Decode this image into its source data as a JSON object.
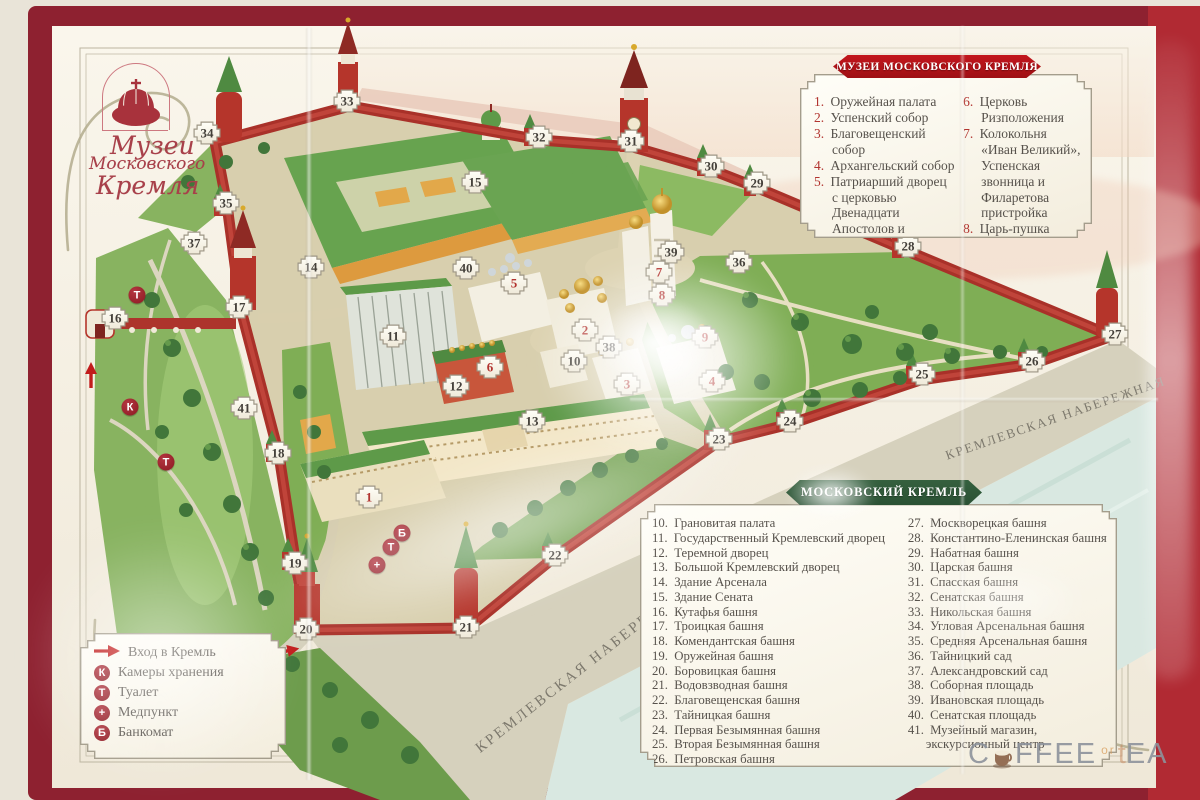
{
  "colors": {
    "border_red": "#8e2130",
    "banner_red": "#c3161d",
    "banner_green": "#2a5134",
    "marker_red": "#b23430",
    "wall_red": "#a93129",
    "paper": "#f7f3e8",
    "text": "#57524c",
    "logo_red": "#a8404a"
  },
  "logo": {
    "line1": "Музеи",
    "line2": "Московского",
    "line3": "Кремля"
  },
  "legend_museums": {
    "banner": "МУЗЕИ МОСКОВСКОГО КРЕМЛЯ",
    "items_left": [
      {
        "n": "1",
        "text": "Оружейная палата"
      },
      {
        "n": "2",
        "text": "Успенский собор"
      },
      {
        "n": "3",
        "text": "Благовещенский собор"
      },
      {
        "n": "4",
        "text": "Архангельский собор"
      },
      {
        "n": "5",
        "text": "Патриарший дворец с церковью Двенадцати Апостолов и выставочный зал в Одностолпной палате"
      }
    ],
    "items_right": [
      {
        "n": "6",
        "text": "Церковь Ризположения"
      },
      {
        "n": "7",
        "text": "Колокольня «Иван Великий», Успенская звонница и Филаретова пристройка"
      },
      {
        "n": "8",
        "text": "Царь-пушка"
      },
      {
        "n": "9",
        "text": "Царь-колокол"
      }
    ]
  },
  "legend_kremlin": {
    "banner": "МОСКОВСКИЙ КРЕМЛЬ",
    "items_left": [
      {
        "n": "10",
        "text": "Грановитая палата"
      },
      {
        "n": "11",
        "text": "Государственный Кремлевский дворец"
      },
      {
        "n": "12",
        "text": "Теремной дворец"
      },
      {
        "n": "13",
        "text": "Большой Кремлевский дворец"
      },
      {
        "n": "14",
        "text": "Здание Арсенала"
      },
      {
        "n": "15",
        "text": "Здание Сената"
      },
      {
        "n": "16",
        "text": "Кутафья башня"
      },
      {
        "n": "17",
        "text": "Троицкая башня"
      },
      {
        "n": "18",
        "text": "Комендантская башня"
      },
      {
        "n": "19",
        "text": "Оружейная башня"
      },
      {
        "n": "20",
        "text": "Боровицкая башня"
      },
      {
        "n": "21",
        "text": "Водовзводная башня"
      },
      {
        "n": "22",
        "text": "Благовещенская башня"
      },
      {
        "n": "23",
        "text": "Тайницкая башня"
      },
      {
        "n": "24",
        "text": "Первая Безымянная башня"
      },
      {
        "n": "25",
        "text": "Вторая Безымянная башня"
      },
      {
        "n": "26",
        "text": "Петровская башня"
      }
    ],
    "items_right": [
      {
        "n": "27",
        "text": "Москворецкая башня"
      },
      {
        "n": "28",
        "text": "Константино-Еленинская башня"
      },
      {
        "n": "29",
        "text": "Набатная башня"
      },
      {
        "n": "30",
        "text": "Царская башня"
      },
      {
        "n": "31",
        "text": "Спасская башня"
      },
      {
        "n": "32",
        "text": "Сенатская башня"
      },
      {
        "n": "33",
        "text": "Никольская башня"
      },
      {
        "n": "34",
        "text": "Угловая Арсенальная башня"
      },
      {
        "n": "35",
        "text": "Средняя Арсенальная башня"
      },
      {
        "n": "36",
        "text": "Тайницкий сад"
      },
      {
        "n": "37",
        "text": "Александровский сад"
      },
      {
        "n": "38",
        "text": "Соборная площадь"
      },
      {
        "n": "39",
        "text": "Ивановская площадь"
      },
      {
        "n": "40",
        "text": "Сенатская площадь"
      },
      {
        "n": "41",
        "text": "Музейный магазин, экскурсионный центр"
      }
    ]
  },
  "legend_services": {
    "items": [
      {
        "icon": "arrow",
        "label": "Вход в Кремль"
      },
      {
        "icon": "К",
        "label": "Камеры хранения"
      },
      {
        "icon": "Т",
        "label": "Туалет"
      },
      {
        "icon": "+",
        "label": "Медпункт"
      },
      {
        "icon": "Б",
        "label": "Банкомат"
      }
    ]
  },
  "map": {
    "embankment_label": "КРЕМЛЕВСКАЯ НАБЕРЕЖНАЯ",
    "markers": [
      {
        "n": "1",
        "x": 369,
        "y": 497,
        "red": true
      },
      {
        "n": "2",
        "x": 585,
        "y": 330,
        "red": true
      },
      {
        "n": "3",
        "x": 627,
        "y": 384,
        "red": true
      },
      {
        "n": "4",
        "x": 712,
        "y": 381,
        "red": true
      },
      {
        "n": "5",
        "x": 514,
        "y": 283,
        "red": true
      },
      {
        "n": "6",
        "x": 490,
        "y": 367,
        "red": true
      },
      {
        "n": "7",
        "x": 659,
        "y": 272,
        "red": true
      },
      {
        "n": "8",
        "x": 662,
        "y": 295,
        "red": true
      },
      {
        "n": "9",
        "x": 705,
        "y": 337,
        "red": true
      },
      {
        "n": "10",
        "x": 574,
        "y": 361
      },
      {
        "n": "11",
        "x": 393,
        "y": 336
      },
      {
        "n": "12",
        "x": 456,
        "y": 386
      },
      {
        "n": "13",
        "x": 532,
        "y": 421
      },
      {
        "n": "14",
        "x": 311,
        "y": 267
      },
      {
        "n": "15",
        "x": 475,
        "y": 182
      },
      {
        "n": "16",
        "x": 115,
        "y": 318
      },
      {
        "n": "17",
        "x": 239,
        "y": 307
      },
      {
        "n": "18",
        "x": 278,
        "y": 453
      },
      {
        "n": "19",
        "x": 295,
        "y": 563
      },
      {
        "n": "20",
        "x": 306,
        "y": 629
      },
      {
        "n": "21",
        "x": 466,
        "y": 627
      },
      {
        "n": "22",
        "x": 555,
        "y": 555
      },
      {
        "n": "23",
        "x": 719,
        "y": 439
      },
      {
        "n": "24",
        "x": 790,
        "y": 421
      },
      {
        "n": "25",
        "x": 922,
        "y": 374
      },
      {
        "n": "26",
        "x": 1032,
        "y": 361
      },
      {
        "n": "27",
        "x": 1115,
        "y": 334
      },
      {
        "n": "28",
        "x": 908,
        "y": 246
      },
      {
        "n": "29",
        "x": 757,
        "y": 183
      },
      {
        "n": "30",
        "x": 711,
        "y": 166
      },
      {
        "n": "31",
        "x": 631,
        "y": 141
      },
      {
        "n": "32",
        "x": 539,
        "y": 137
      },
      {
        "n": "33",
        "x": 347,
        "y": 101
      },
      {
        "n": "34",
        "x": 207,
        "y": 133
      },
      {
        "n": "35",
        "x": 226,
        "y": 203
      },
      {
        "n": "36",
        "x": 739,
        "y": 262
      },
      {
        "n": "37",
        "x": 194,
        "y": 243
      },
      {
        "n": "38",
        "x": 609,
        "y": 347
      },
      {
        "n": "39",
        "x": 671,
        "y": 252
      },
      {
        "n": "40",
        "x": 466,
        "y": 268
      },
      {
        "n": "41",
        "x": 244,
        "y": 408
      }
    ],
    "service_markers": [
      {
        "t": "Т",
        "x": 137,
        "y": 295
      },
      {
        "t": "К",
        "x": 130,
        "y": 407
      },
      {
        "t": "Т",
        "x": 166,
        "y": 462
      },
      {
        "t": "Б",
        "x": 402,
        "y": 533
      },
      {
        "t": "Т",
        "x": 391,
        "y": 547
      },
      {
        "t": "+",
        "x": 377,
        "y": 565
      }
    ],
    "entrance_arrows": [
      {
        "x": 93,
        "y": 372,
        "rot": -90
      },
      {
        "x": 287,
        "y": 650,
        "rot": -12
      }
    ]
  },
  "watermark": {
    "c": "C",
    "ffee": "FFEE",
    "or": "or",
    "tea": "EA"
  }
}
